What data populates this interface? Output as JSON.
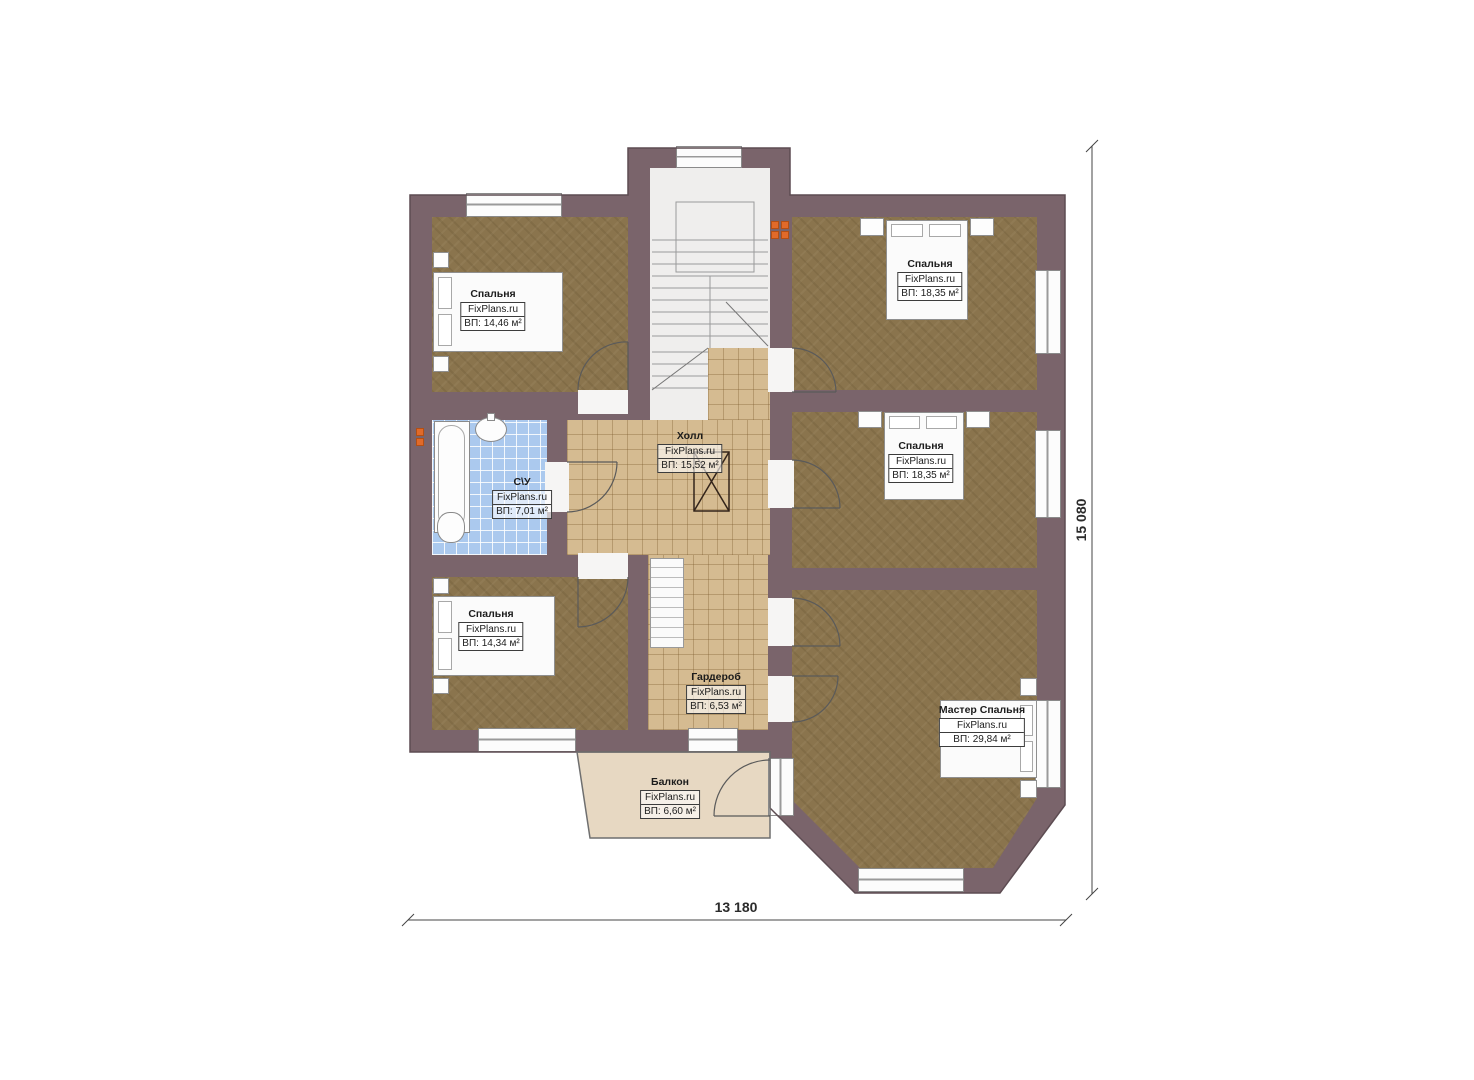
{
  "rooms": {
    "bedroom_tl": {
      "name": "Спальня",
      "site": "FixPlans.ru",
      "area": "ВП: 14,46 м²"
    },
    "bedroom_tr": {
      "name": "Спальня",
      "site": "FixPlans.ru",
      "area": "ВП: 18,35 м²"
    },
    "bedroom_mr": {
      "name": "Спальня",
      "site": "FixPlans.ru",
      "area": "ВП: 18,35 м²"
    },
    "bathroom": {
      "name": "С\\У",
      "site": "FixPlans.ru",
      "area": "ВП: 7,01 м²"
    },
    "hall": {
      "name": "Холл",
      "site": "FixPlans.ru",
      "area": "ВП: 15,52 м²"
    },
    "bedroom_bl": {
      "name": "Спальня",
      "site": "FixPlans.ru",
      "area": "ВП: 14,34 м²"
    },
    "wardrobe": {
      "name": "Гардероб",
      "site": "FixPlans.ru",
      "area": "ВП: 6,53 м²"
    },
    "master": {
      "name": "Мастер Спальня",
      "site": "FixPlans.ru",
      "area": "ВП: 29,84 м²"
    },
    "balcony": {
      "name": "Балкон",
      "site": "FixPlans.ru",
      "area": "ВП: 6,60 м²"
    }
  },
  "dimensions": {
    "width_label": "13 180",
    "height_label": "15 080"
  },
  "colors": {
    "wall": "#7a646b",
    "carpet": "#8a744d",
    "tile": "#d5bb91",
    "bath_tile": "#abc9ee",
    "balcony": "#e7d8c2",
    "stairs": "#efeeed",
    "radiator": "#e06a2a"
  }
}
